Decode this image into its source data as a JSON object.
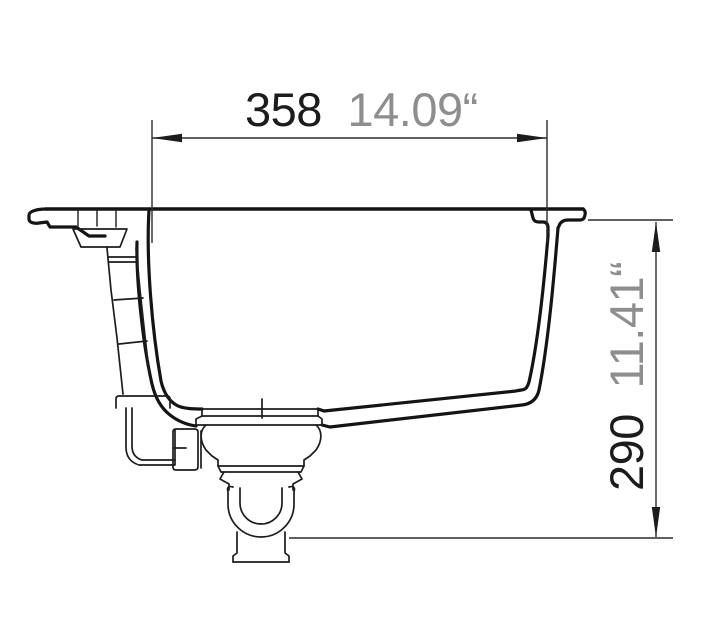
{
  "drawing": {
    "type": "technical-cross-section",
    "subject": "sink-side-profile-with-drain"
  },
  "dimensions": {
    "width": {
      "mm": "358",
      "inches": "14.09“"
    },
    "depth": {
      "mm": "290",
      "inches": "11.41“"
    }
  },
  "colors": {
    "outline": "#141414",
    "detail": "#1d1d1d",
    "dimension_line": "#2b2b2b",
    "primary_text": "#1c1c1c",
    "secondary_text": "#8e8e8e",
    "background": "#ffffff"
  }
}
